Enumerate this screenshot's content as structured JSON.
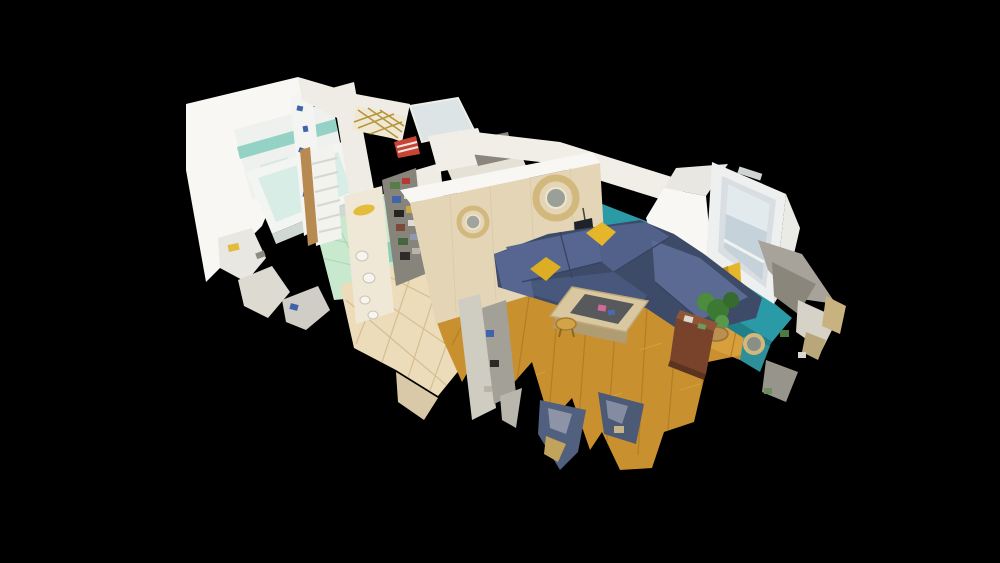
{
  "scene": {
    "view": "3D dollhouse cutaway of an attic apartment, floating on a black background, seen from a high oblique angle",
    "rooms": [
      {
        "name": "bathroom",
        "features": [
          "white tiled walls with aqua border stripe",
          "bathtub",
          "shower curtain with blue pattern",
          "towel radiator",
          "mint green tiled floor",
          "fragmented sink fixtures"
        ]
      },
      {
        "name": "hallway",
        "features": [
          "beige ceramic tile floor",
          "cream wall with decorative plates",
          "yellow wall ornament",
          "storage shelf with clutter",
          "washing machine"
        ]
      },
      {
        "name": "kitchen",
        "features": [
          "white cabinets",
          "dark countertop appliances",
          "gold trellis decor",
          "skylight"
        ]
      },
      {
        "name": "living-room",
        "features": [
          "oak parquet floor",
          "navy corner sofa",
          "mustard yellow cushions",
          "teal accent wall",
          "dormer window",
          "wood and glass coffee table",
          "round rattan mirrors",
          "hanging black bag",
          "potted plant",
          "mahogany sideboard",
          "scan-noise chair fragments"
        ]
      }
    ],
    "colors": {
      "background": "#000000",
      "wall_bright": "#f8f7f3",
      "wall_white": "#efece5",
      "wall_cream": "#f0e8d6",
      "wall_beige": "#e4d5b6",
      "wall_teal": "#2b9aa7",
      "tile_white": "#eef1ee",
      "tile_aqua": "#93d2c5",
      "tub_white": "#f3f5f2",
      "tub_inner": "#d8ede5",
      "curtain_white": "#f4f4f2",
      "curtain_blue": "#3f64aa",
      "floor_mint": "#c9e9cf",
      "mint_line": "#aad6b6",
      "floor_tile": "#eddcba",
      "tile_line": "#d6bd92",
      "floor_parquet": "#c8902f",
      "parquet_line": "#b57d26",
      "radiator_white": "#f2f2ee",
      "door_wood": "#b68a50",
      "gold": "#b6933c",
      "skylight": "#dce4e6",
      "cabinet_white": "#f0eee7",
      "sofa_blue": "#4d5c80",
      "sofa_dark": "#3d4b69",
      "sofa_light": "#566691",
      "pillow_yellow": "#e6b62a",
      "accent_yellow": "#e3bc3d",
      "table_wood": "#d8c79f",
      "stool_wood": "#d2a347",
      "rattan": "#d3b87e",
      "window_frame": "#eef0f0",
      "window_glass": "#c5d2da",
      "plant_green": "#4c8c3c",
      "sideboard_brown": "#78432a",
      "noise_gray": "#a7a39a",
      "noise_light": "#d6d2c8"
    }
  }
}
